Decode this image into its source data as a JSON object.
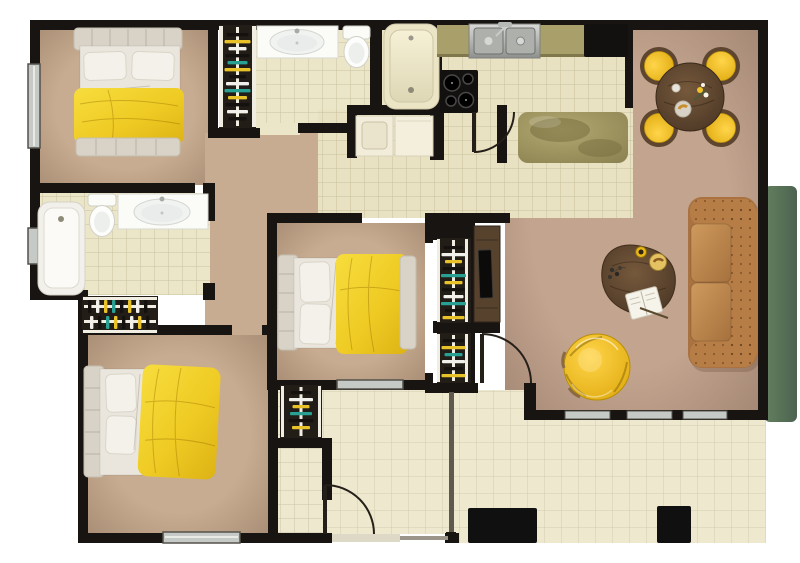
{
  "meta": {
    "title": "Apartment Floor Plan",
    "description": "Top-down 2D rendered floor plan of a three-bedroom, two-bathroom apartment with kitchen, dining area, living room, laundry nook, entry walkway and tiled patio"
  },
  "palette": {
    "wall": "#181411",
    "carpet": "#c7ac91",
    "carpet_living": "#c2a48f",
    "tile_bath": "#ece6c9",
    "tile_kitchen": "#e9e2c2",
    "tile_patio": "#eee8cf",
    "duvet": "#f0cd27",
    "pillow": "#f3f1ea",
    "headboard": "#d9d3c7",
    "mattress": "#eae6dd",
    "closet_bg": "#221d17",
    "rail": "#f0ede3",
    "cloth_black": "#14110e",
    "cloth_yellow": "#e8c228",
    "cloth_teal": "#28a093",
    "cloth_white": "#f1f0ea",
    "fixture_white": "#fbfbf8",
    "tub_cream": "#ece5c5",
    "steel": "#b9bbb8",
    "appliance_black": "#131110",
    "counter_olive": "#a89f6b",
    "walnut": "#5e4733",
    "sofa": "#b67d46",
    "chair_yellow": "#e6c226",
    "hedge": "#5d7560",
    "glass": "#c6cac6",
    "planter": "#101010",
    "threshold": "#ded8c6"
  },
  "rooms": [
    {
      "name": "bedroom-1",
      "floor": "carpet",
      "furniture": [
        "double-bed-yellow-duvet",
        "hanger-closet",
        "window"
      ]
    },
    {
      "name": "bathroom-1",
      "floor": "tile",
      "furniture": [
        "vanity-sink",
        "toilet",
        "bathtub"
      ]
    },
    {
      "name": "laundry-nook",
      "floor": "tile",
      "furniture": [
        "washer",
        "dryer-counter"
      ]
    },
    {
      "name": "kitchen",
      "floor": "tile",
      "furniture": [
        "counter",
        "double-steel-sink",
        "refrigerator",
        "cooktop",
        "island"
      ]
    },
    {
      "name": "dining-area",
      "floor": "carpet",
      "furniture": [
        "round-walnut-table",
        "four-yellow-chairs"
      ]
    },
    {
      "name": "living-room",
      "floor": "carpet",
      "furniture": [
        "chesterfield-sofa",
        "coffee-table",
        "yellow-armchair",
        "tv-console",
        "sliding-glass-doors"
      ]
    },
    {
      "name": "bedroom-2",
      "floor": "carpet",
      "furniture": [
        "double-bed-yellow-duvet",
        "two-hanger-closets",
        "window"
      ]
    },
    {
      "name": "bathroom-2",
      "floor": "tile",
      "furniture": [
        "bathtub",
        "toilet",
        "vanity-sink",
        "window"
      ]
    },
    {
      "name": "bedroom-3",
      "floor": "carpet",
      "furniture": [
        "double-bed-yellow-duvet",
        "hanger-closet",
        "window"
      ]
    },
    {
      "name": "entry",
      "floor": "tile",
      "furniture": [
        "hanger-closet",
        "entry-door",
        "threshold"
      ]
    },
    {
      "name": "patio",
      "floor": "tile",
      "furniture": [
        "planter",
        "planter",
        "divider-screen",
        "hedge"
      ]
    }
  ],
  "doors": [
    "kitchen-swing-door",
    "living-room-swing-door",
    "entry-swing-door"
  ],
  "windows": [
    "bedroom-1-left",
    "bathroom-2-left",
    "bedroom-3-bottom",
    "bedroom-2-bottom",
    "living-room-sliding-glass"
  ]
}
